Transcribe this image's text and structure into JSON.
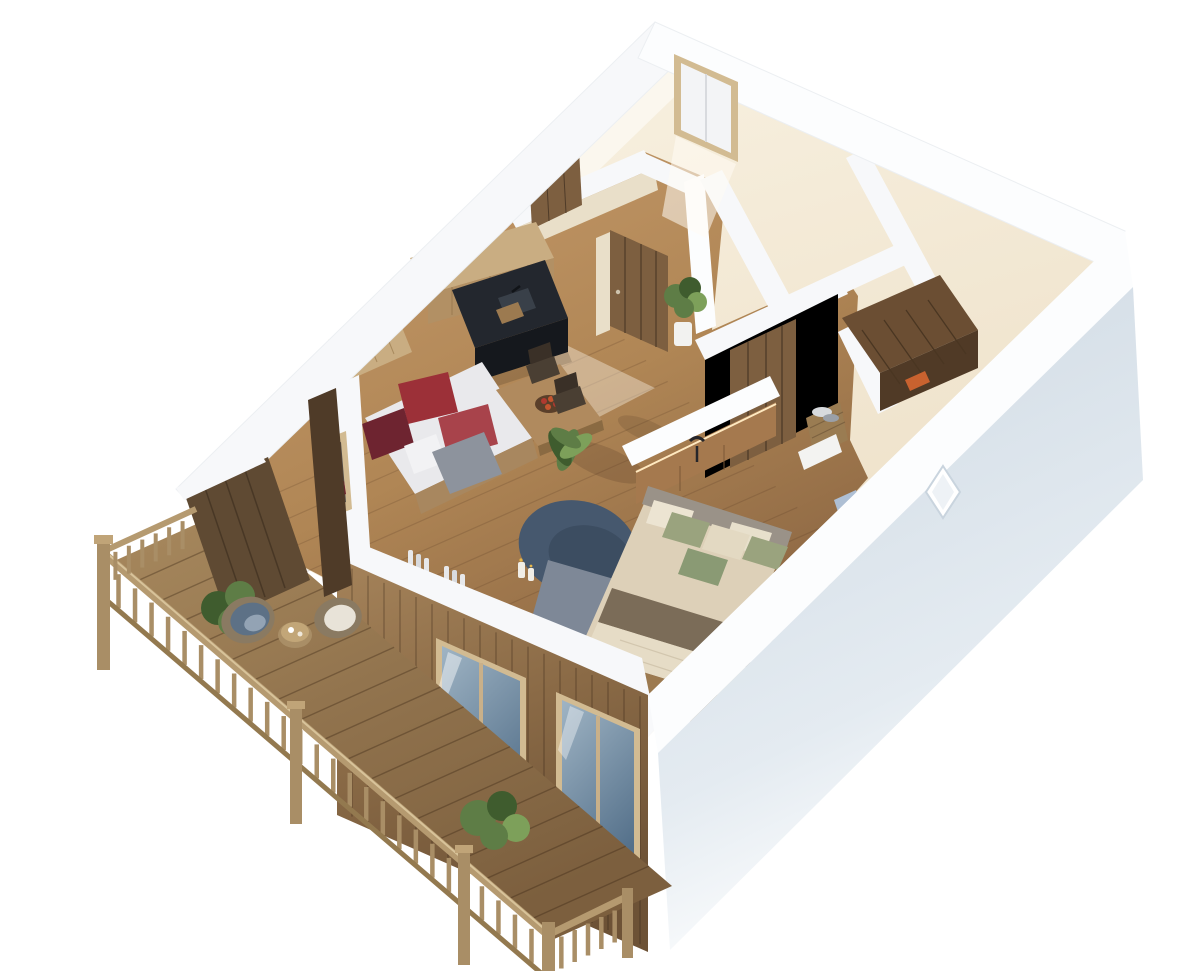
{
  "scene": {
    "type": "3d-floorplan-render",
    "view": "isometric-top-down",
    "objects": [
      "exterior-white-cut-walls",
      "ne-wall-window",
      "se-wall-diamond-window",
      "rustic-wood-facade",
      "facade-glass-doors",
      "balcony-deck",
      "balcony-railing",
      "balcony-shrubs",
      "balcony-round-chairs",
      "balcony-coffee-table",
      "kitchen-black-counter",
      "kitchen-wood-shelf",
      "kitchen-sink",
      "daybed-sofa",
      "red-pillows",
      "picket-partition",
      "dining-table",
      "apple-bowl",
      "wood-chairs",
      "potted-plants",
      "round-blue-rug",
      "bathtub",
      "candles",
      "red-stool",
      "curtained-windows",
      "bed",
      "sage-pillows",
      "wood-headboard-panel",
      "nightstand",
      "reading-lamp",
      "gray-runner-rug",
      "foot-bench",
      "rustic-doors",
      "laundry-basket",
      "sauna-wood-box",
      "entry-plant"
    ]
  },
  "colors": {
    "background": "#ffffff",
    "wall_top": "#f7f8fa",
    "wall_top_bright": "#fcfdfe",
    "wall_edge": "#e4e7eb",
    "cream_light": "#f8f1e0",
    "cream_dark": "#eee2cb",
    "cream_shadow": "#e9dfc9",
    "wood_floor_light": "#c59a6b",
    "wood_floor_dark": "#8f6a45",
    "wood_dark": "#5f4a33",
    "wood_rustic": "#7d5f40",
    "wood_rustic_dark": "#4f3b28",
    "wood_light": "#c9ad82",
    "wood_mid": "#a5794e",
    "deck_wood": "#9c7c53",
    "railing_wood": "#a98e66",
    "railing_cap": "#c0a478",
    "counter_black": "#23272e",
    "counter_black_dark": "#15181d",
    "sink_gray": "#394049",
    "sofa_white": "#e9e9ec",
    "blanket_gray": "#8d939d",
    "pillow_red": "#9c3038",
    "pillow_red_bright": "#a8434b",
    "pillow_maroon": "#6e2430",
    "rug_blue": "#46586e",
    "runner_gray": "#7e8897",
    "bed_beige": "#ddd0b8",
    "bed_white": "#e6dcc6",
    "throw_brown": "#7b6c58",
    "pillow_sage": "#9aa37e",
    "pillow_sage_dark": "#8a9a74",
    "pillow_cream": "#e3d9c2",
    "headboard_gray": "#9a9288",
    "tub_white": "#eef1f3",
    "water_blue": "#4f7186",
    "water_light": "#6d8da1",
    "glass_blue": "#7f97a9",
    "glass_blue_dark": "#54708a",
    "curtain": "#e7e8ea",
    "plant_green": "#5e7d46",
    "plant_green_dark": "#3f5c2e",
    "plant_green_light": "#7da05a",
    "pot_white": "#f2f2f0",
    "chair_blue": "#5d7186",
    "chair_blue_light": "#93a3b4",
    "wicker": "#8a7a62",
    "cushion_white": "#e8e3d8",
    "se_face_blue": "#cdd8e2",
    "frame_tan": "#d2bb92",
    "apple_red": "#b03a30",
    "apple_orange": "#c4552f",
    "basket": "#9a7c52",
    "towel_orange": "#c9622f",
    "box_blue": "#aebfd4",
    "lamp_black": "#26262a",
    "table_wood": "#b08a5e",
    "bowl_brown": "#5a3f2a",
    "chair_dark": "#3a3027",
    "shelf_front": "#b29064",
    "sofa_base": "#a8875f",
    "bench_wood": "#9c7a50",
    "candle_white": "#f0ede6",
    "flame": "#e8b84b",
    "stool_red": "#8e2630",
    "towel_white": "#efeae2",
    "nightstand_wood": "#9a7448",
    "nightstand_front": "#7d5c38",
    "sauna_top": "#6b4e33",
    "sauna_front": "#503a26",
    "towel_gray": "#9aa0a8",
    "towel_light": "#d7dadd",
    "book_white": "#f5f3ee"
  }
}
